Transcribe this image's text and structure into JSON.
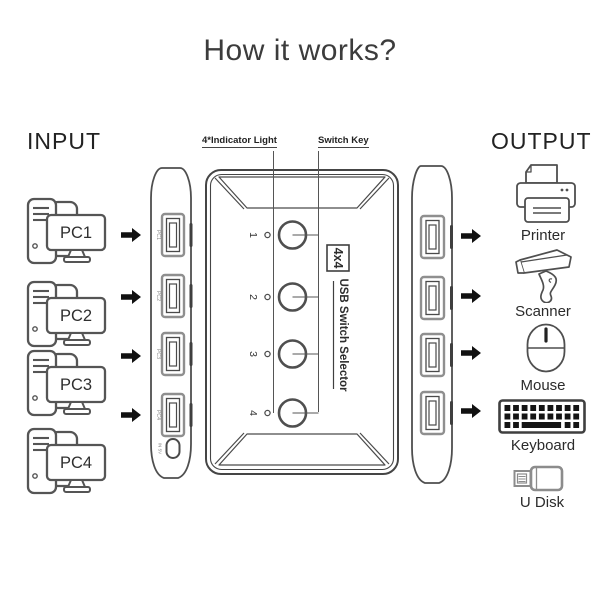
{
  "title": "How it works?",
  "input": {
    "heading": "INPUT",
    "pcs": [
      {
        "label": "PC1"
      },
      {
        "label": "PC2"
      },
      {
        "label": "PC3"
      },
      {
        "label": "PC4"
      }
    ]
  },
  "device": {
    "indicator_label": "4*Indicator Light",
    "switch_key_label": "Switch Key",
    "badge": "4x4",
    "name": "USB Switch Selector",
    "channels": [
      "1",
      "2",
      "3",
      "4"
    ],
    "input_ports": [
      "PC1",
      "PC2",
      "PC3",
      "PC4"
    ],
    "power_port_label": "IN 5V"
  },
  "output": {
    "heading": "OUTPUT",
    "devices": [
      {
        "name": "Printer"
      },
      {
        "name": "Scanner"
      },
      {
        "name": "Mouse"
      },
      {
        "name": "Keyboard"
      },
      {
        "name": "U Disk"
      }
    ]
  },
  "colors": {
    "line": "#4a4a4a",
    "port_gray": "#8f8f8f",
    "arrow": "#111111",
    "background": "#ffffff"
  }
}
